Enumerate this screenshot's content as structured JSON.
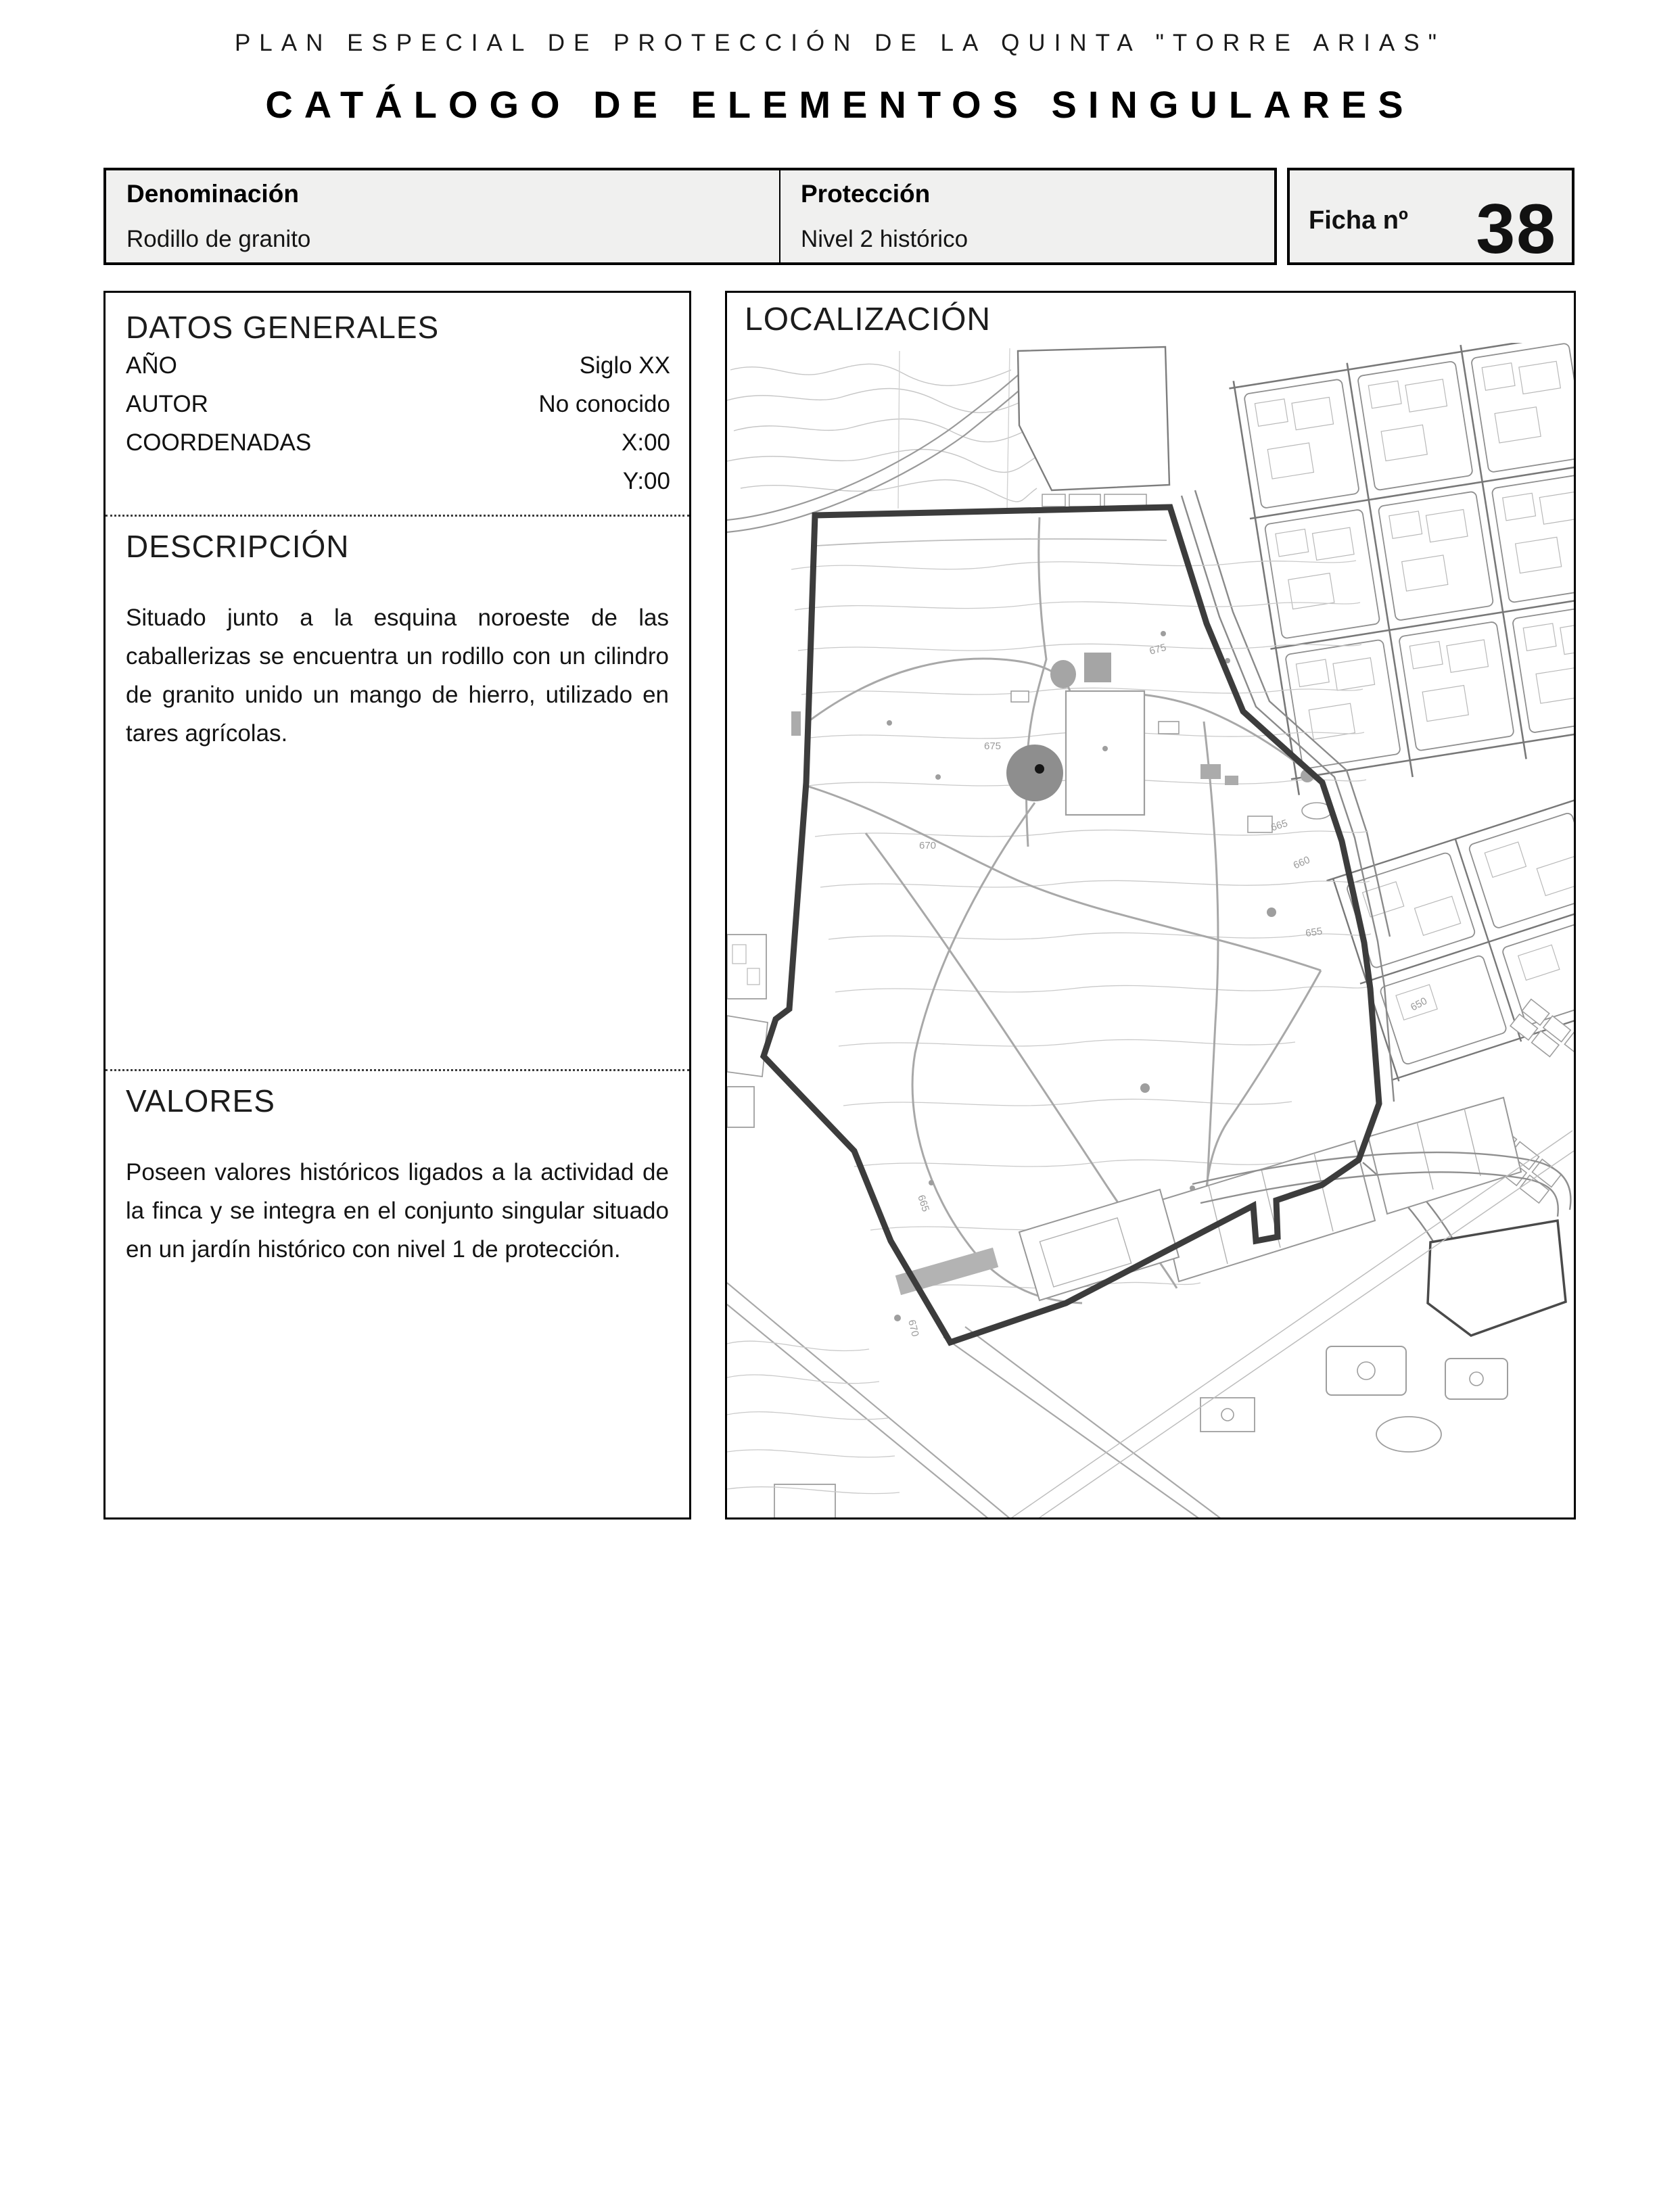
{
  "header": {
    "supertitle": "PLAN ESPECIAL DE PROTECCIÓN DE LA QUINTA \"TORRE ARIAS\"",
    "title": "CATÁLOGO DE ELEMENTOS SINGULARES"
  },
  "summary": {
    "denominacion_label": "Denominación",
    "denominacion_value": "Rodillo de granito",
    "proteccion_label": "Protección",
    "proteccion_value": "Nivel 2 histórico",
    "ficha_label": "Ficha nº",
    "ficha_number": "38"
  },
  "datos_generales": {
    "heading": "DATOS GENERALES",
    "rows": [
      {
        "label": "AÑO",
        "value": "Siglo XX"
      },
      {
        "label": "AUTOR",
        "value": "No conocido"
      },
      {
        "label": "COORDENADAS",
        "value": "X:00"
      },
      {
        "label": "",
        "value": "Y:00"
      }
    ]
  },
  "descripcion": {
    "heading": "DESCRIPCIÓN",
    "text": "Situado junto a la esquina noroeste de las caballerizas se encuentra un rodillo con un cilindro de granito unido un mango de hierro, utilizado en tares agrícolas."
  },
  "valores": {
    "heading": "VALORES",
    "text": "Poseen valores históricos ligados a la actividad de la finca y se integra en el conjunto singular situado en un jardín histórico con nivel 1 de protección."
  },
  "localizacion": {
    "heading": "LOCALIZACIÓN",
    "elevation_labels": [
      "675",
      "675",
      "670",
      "665",
      "660",
      "655",
      "650",
      "670",
      "665"
    ],
    "colors": {
      "boundary": "#3c3c3c",
      "contour": "#c6c6c6",
      "path": "#a8a8a8",
      "street": "#787878",
      "parcel": "#b8b8b8",
      "marker_fill": "#8e8e8e",
      "marker_dot": "#151515"
    }
  }
}
